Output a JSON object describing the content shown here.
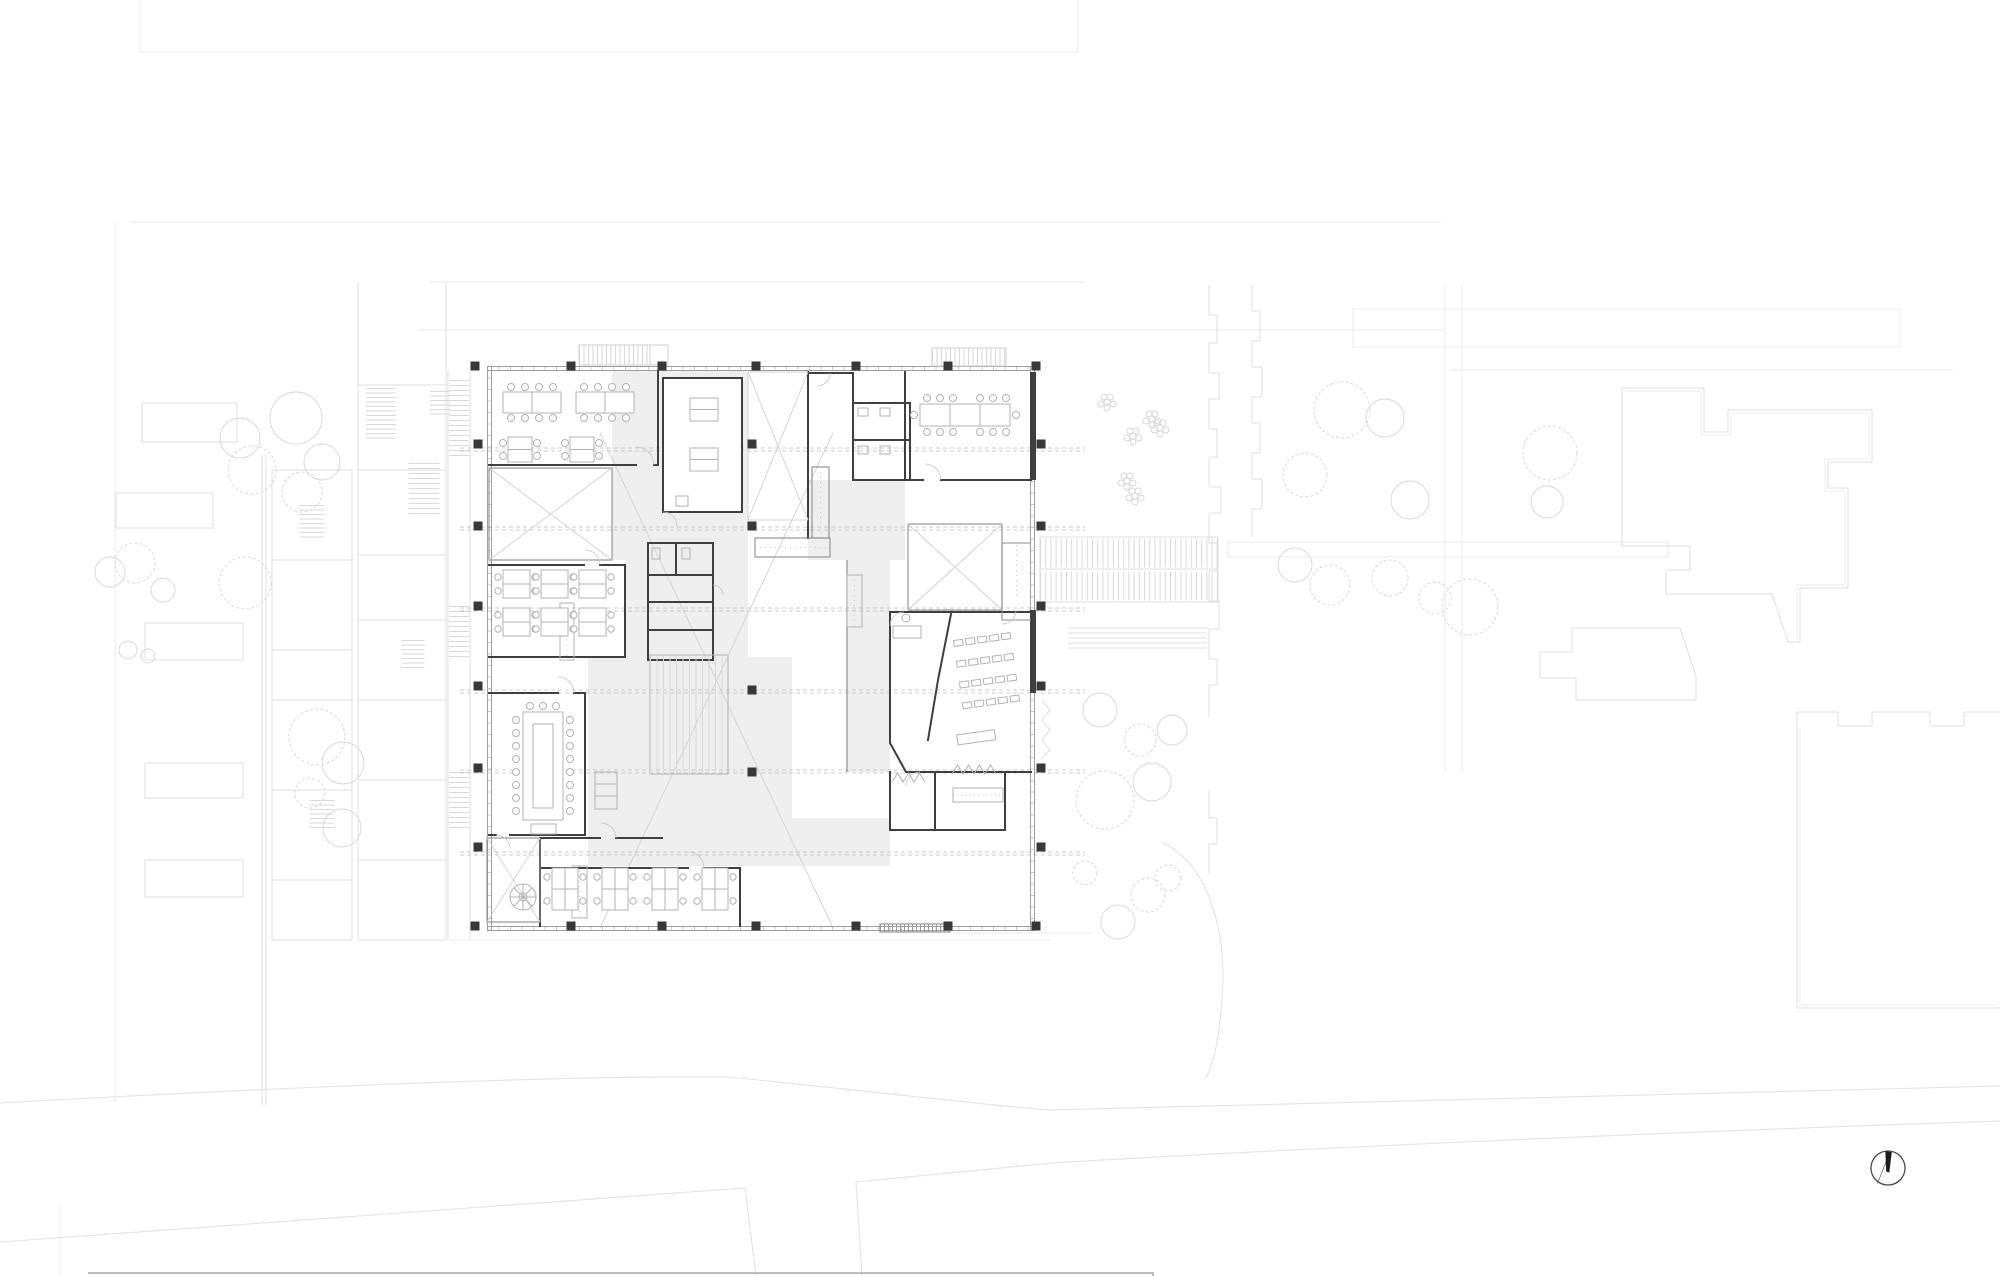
{
  "page": {
    "width": 2000,
    "height": 1276,
    "kind": "architectural site and floor plan drawing, line work only, no visible text"
  },
  "palette": {
    "paper": "#ffffff",
    "wall": "#3f3f3f",
    "wall2": "#8c8c8c",
    "glass": "#9e9e9e",
    "column": "#383838",
    "furn": "#b3b3b3",
    "shade": "#eeeeee",
    "hatch": "#c6c6c6",
    "hatch2": "#d9d9d9",
    "dash": "#bdbdbd",
    "xbrace": "#d2d2d2",
    "ctx": "#dfdfdf",
    "ctx2": "#cfcfcf",
    "tree": "#d6d6d6",
    "road": "#e3e3e3",
    "faint": "#ebebeb",
    "arrow": "#1c1c1c"
  },
  "plan": {
    "building": {
      "outline": "square glazed pavilion, seven structural bays",
      "grid_columns_x": [
        475,
        571,
        662,
        756,
        856,
        948,
        1036
      ],
      "grid_rows_y": [
        366,
        448,
        530,
        610,
        690,
        772,
        851,
        933
      ],
      "dashed_axes_y": [
        448,
        527,
        608,
        690,
        770,
        852
      ],
      "rooms": [
        {
          "id": "office-nw",
          "furniture": "two 8-seat work tables, two 4-seat desks"
        },
        {
          "id": "void-nw",
          "furniture": "cross-braced void"
        },
        {
          "id": "classroom-w",
          "furniture": "six double desks with chairs"
        },
        {
          "id": "meeting-w",
          "furniture": "U-shaped conference table with 19 chairs"
        },
        {
          "id": "stair-void-sw",
          "furniture": "cross-braced shaft with spiral stair"
        },
        {
          "id": "open-office-s",
          "furniture": "four 4-desk clusters with chairs"
        },
        {
          "id": "room-n-mid",
          "furniture": "two small work tables"
        },
        {
          "id": "room-n-core",
          "furniture": "small room beside stair"
        },
        {
          "id": "wc-core-n",
          "furniture": "toilet cells with fixtures"
        },
        {
          "id": "conference-ne",
          "furniture": "long table with 14 chairs"
        },
        {
          "id": "wc-core-center",
          "furniture": "toilet core, stalls and fixtures"
        },
        {
          "id": "seminar-se",
          "furniture": "4 rows x 5 seats, lectern, angled partition, tutor desk"
        },
        {
          "id": "entrance-se",
          "furniture": "vestibule, coat zigzags, entrance mat"
        },
        {
          "id": "stair-e",
          "furniture": "straight stair"
        },
        {
          "id": "tiered-steps-center",
          "furniture": "wide tiered seating steps"
        },
        {
          "id": "void-e",
          "furniture": "cross-braced void"
        }
      ],
      "stairs_count": 8,
      "exterior": "hatched entry stairs on north face, wide hatched stair and terraced steps on east plaza"
    }
  },
  "context": {
    "west": "terraced neighbour houses with hatched stairs, garden beds, round and deciduous trees",
    "east": "planted plaza, crenellated party-wall lines, gardens with trees, large stepped neighbour buildings",
    "north": "faint block outlines of buildings across the street",
    "south": "two curving street edge lines with a T-junction lane, sheet title block edge at bottom",
    "trees": {
      "round": 20,
      "deciduous": 18,
      "plant_clusters": 6
    },
    "north_arrow": {
      "present": true,
      "style": "circle with inclined black needle",
      "tilt_deg": 12
    }
  }
}
